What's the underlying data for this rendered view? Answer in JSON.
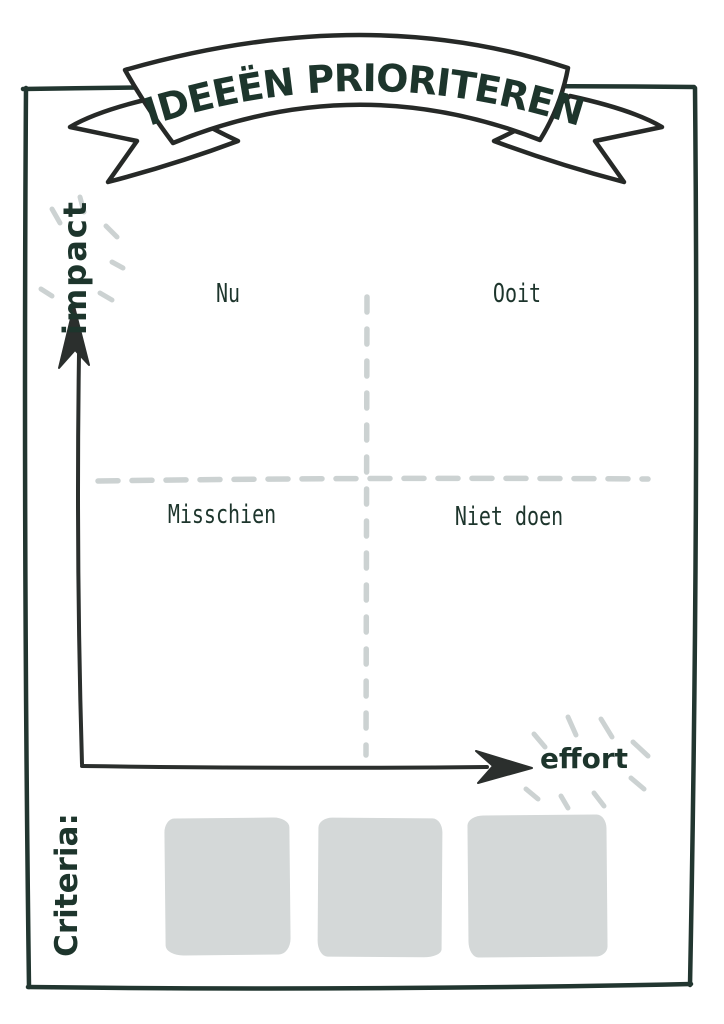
{
  "banner": {
    "title": "IDEEËN PRIORITEREN"
  },
  "matrix": {
    "y_axis_label": "impact",
    "x_axis_label": "effort",
    "quadrants": [
      {
        "position": "top-left",
        "label": "Nu"
      },
      {
        "position": "top-right",
        "label": "Ooit"
      },
      {
        "position": "bottom-left",
        "label": "Misschien"
      },
      {
        "position": "bottom-right",
        "label": "Niet doen"
      }
    ]
  },
  "criteria": {
    "label": "Criteria:",
    "card_count": 3
  },
  "colors": {
    "ink": "#1d352c",
    "line_ink": "#2b2f2d",
    "dash_gray": "#ccd2d2",
    "card_gray": "#d4d8d8",
    "background": "#ffffff"
  }
}
